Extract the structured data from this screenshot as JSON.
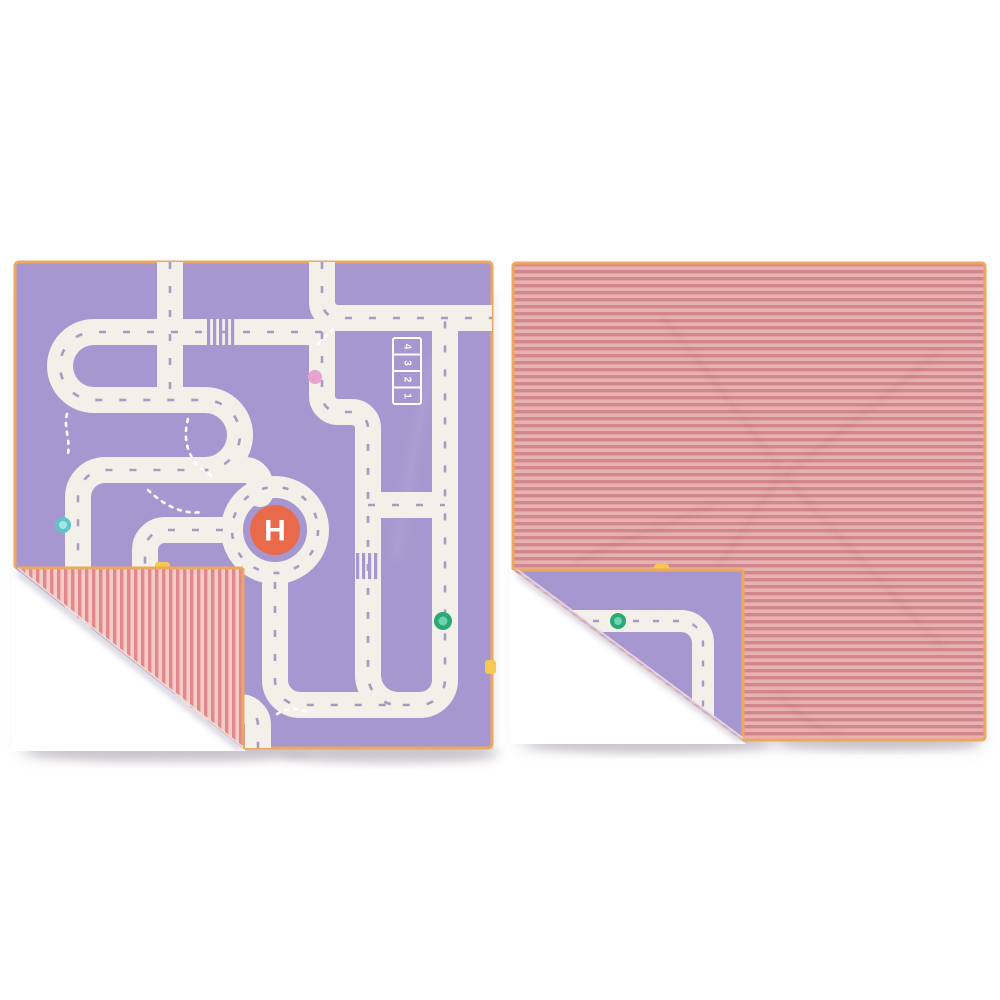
{
  "photo": {
    "background_color": "#ffffff",
    "description": "Reversible kids road play mat shown twice: front purple road side with a folded striped corner, and back striped side with a folded purple corner"
  },
  "left_mat": {
    "name": "road-play-mat-front",
    "base_color": "#a797d0",
    "trim_color": "#eda75f",
    "road_color": "#f2f0e8",
    "dash_color": "#a89bbd",
    "footpath_dot_color": "#ffffff",
    "helipad": {
      "label": "H",
      "pad_color": "#e9694b",
      "label_color": "#ffffff"
    },
    "parking_numbers": [
      "4",
      "3",
      "2",
      "1"
    ],
    "markers": {
      "pink_dot": "#e8a3cf",
      "teal_dot": "#5fc4c9",
      "teal_dot_inner": "#a8e3e4",
      "green_dot": "#2aa877",
      "green_dot_inner": "#6fd3b0"
    },
    "tab_color": "#f5c84f",
    "fold_stripes": {
      "dark": "#e2878e",
      "light": "#f2cdc5",
      "direction": "vertical"
    }
  },
  "right_mat": {
    "name": "striped-mat-back",
    "stripe_dark": "#d2868f",
    "stripe_light": "#e7b2b2",
    "trim_color": "#eda75f",
    "fold": {
      "base_color": "#a797d0",
      "road_color": "#f2f0e8",
      "dash_color": "#a89bbd",
      "marker_color": "#2aa877",
      "marker_inner_color": "#6fd3b0",
      "tab_color": "#f5c84f"
    }
  }
}
